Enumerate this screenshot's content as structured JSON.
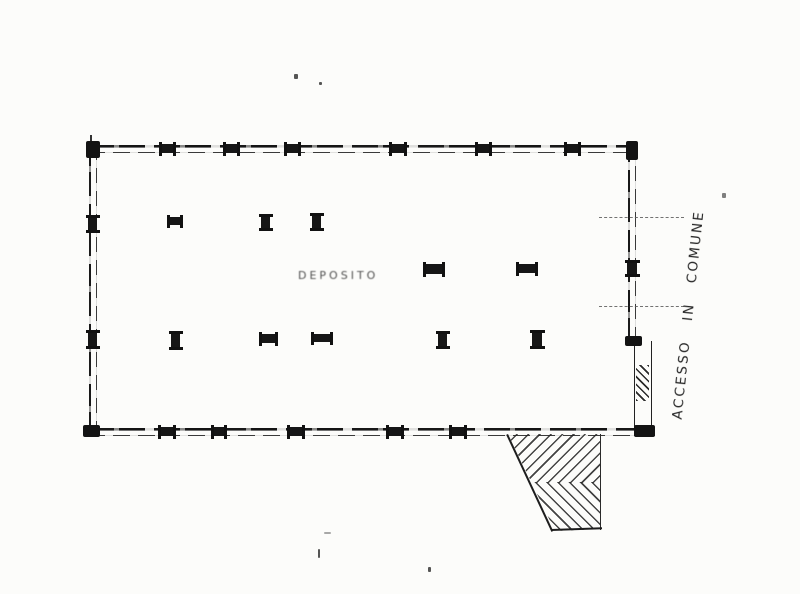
{
  "document": {
    "kind": "scanned floor plan",
    "room_label": "DEPOSITO",
    "side_annotation": "ACCESSO IN COMUNE"
  },
  "colors": {
    "ink": "#1b1b1b",
    "faded_ink": "#4f4f4f",
    "paper": "#fcfcfa"
  }
}
